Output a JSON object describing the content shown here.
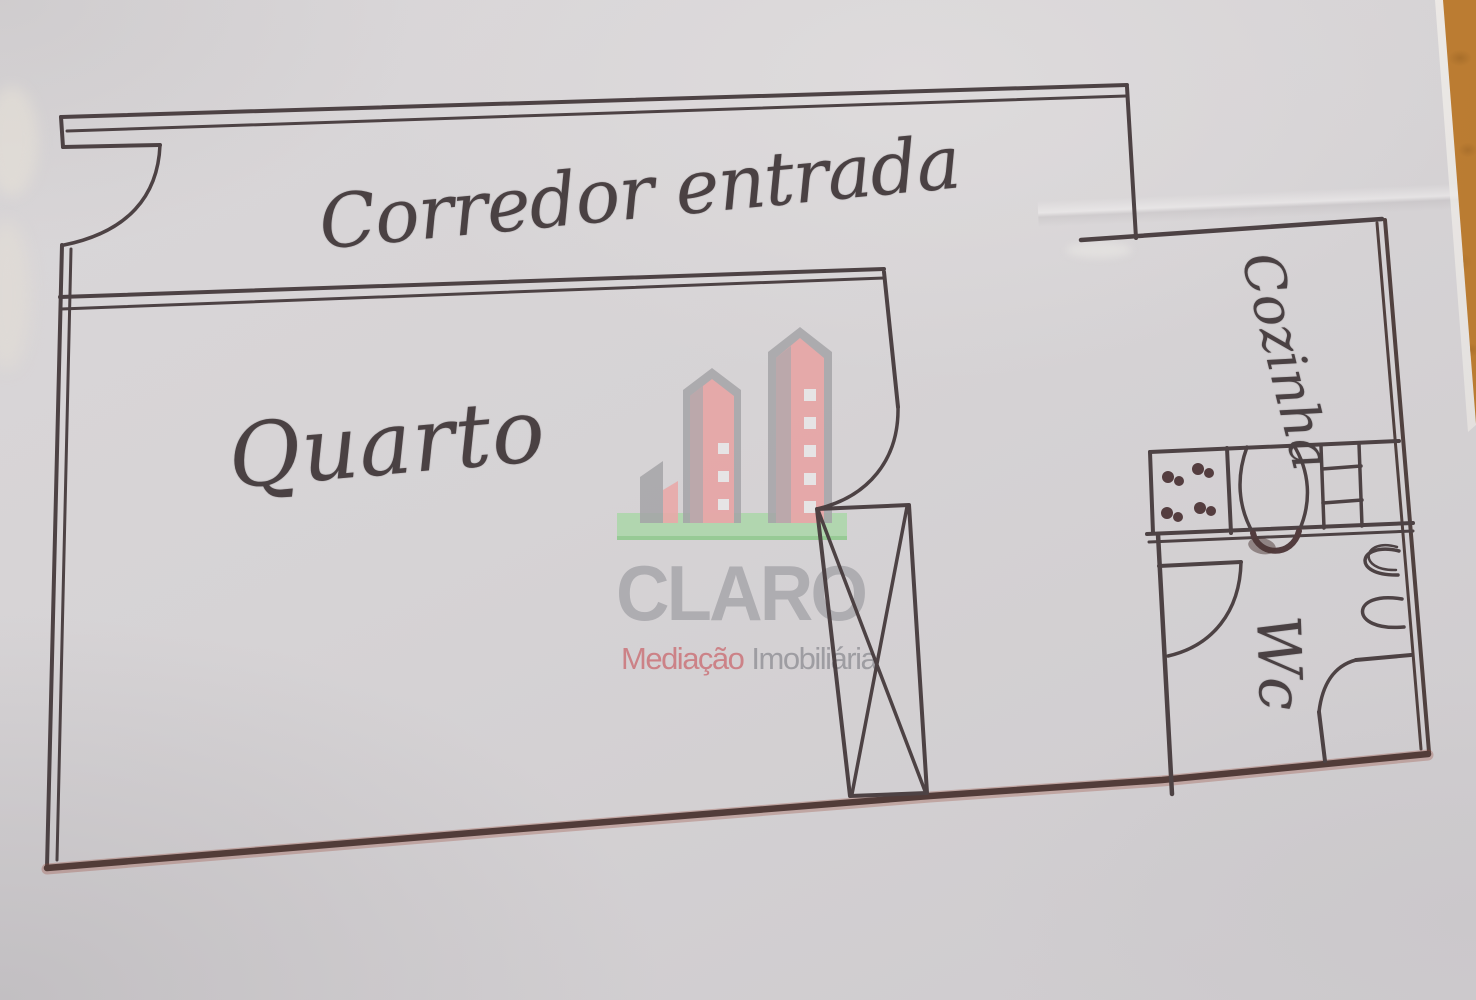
{
  "document": {
    "type": "hand-drawn apartment floor plan photographed on a wooden table",
    "labels": {
      "corridor": "Corredor entrada",
      "bedroom": "Quarto",
      "kitchen": "Cozinha",
      "wc": "Wc"
    },
    "watermark": {
      "brand": "CLARO",
      "tagline_primary": "Mediação",
      "tagline_secondary": "Imobiliária"
    },
    "colors": {
      "paper": "#d6d3d5",
      "ink": "#463b3d",
      "ink_bottom_wall": "#4c3531",
      "wood_table": "#c9893c",
      "brand_gray": "#aeadb1",
      "brand_pink": "#e9a8a8",
      "brand_green": "#a7d7a5",
      "tagline_pink": "#cc8287",
      "tagline_gray": "#9e9da2"
    }
  }
}
